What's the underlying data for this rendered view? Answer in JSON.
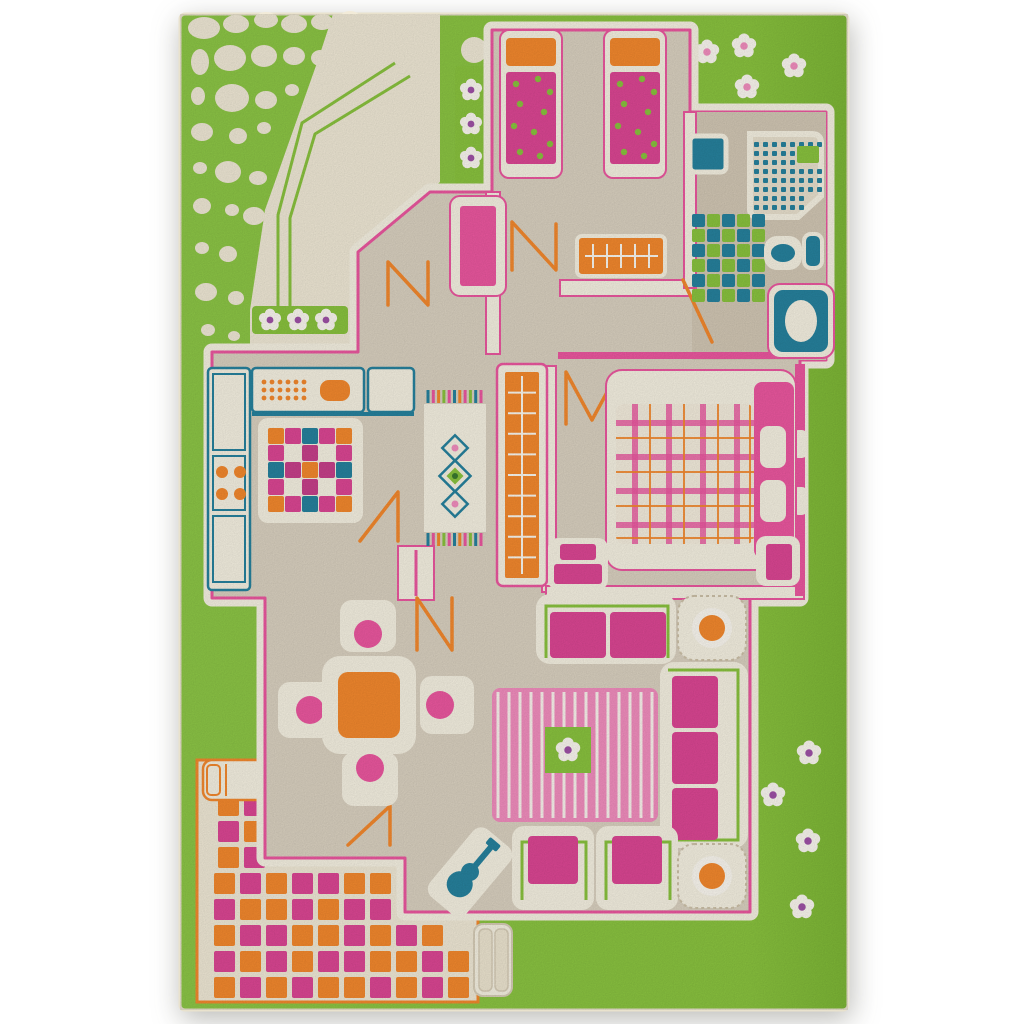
{
  "meta": {
    "description": "Photograph of a 3D children's play rug: green lawn with a playhouse floor plan, furniture, garden pebbles, flowers, tiled patio",
    "object": "play-rug"
  },
  "palette": {
    "bg": "#ffffff",
    "grass": "#8bc53f",
    "grassDeep": "#7eb836",
    "cream": "#f2ebd8",
    "creamBright": "#f8f3e4",
    "floor": "#dcd3c2",
    "floorDark": "#d4c9b6",
    "pink": "#ee58a1",
    "pinkDeep": "#de4795",
    "pinkLight": "#f48fc0",
    "orange": "#f68a2e",
    "teal": "#27839f",
    "lime": "#8bc53f",
    "purple": "#a052a8",
    "white": "#fdfaf2"
  },
  "pebbles": [
    [
      204,
      28,
      16,
      11
    ],
    [
      236,
      24,
      13,
      9
    ],
    [
      266,
      20,
      12,
      8
    ],
    [
      294,
      24,
      13,
      9
    ],
    [
      322,
      22,
      11,
      8
    ],
    [
      350,
      18,
      10,
      7
    ],
    [
      376,
      24,
      9,
      7
    ],
    [
      400,
      20,
      8,
      6
    ],
    [
      422,
      26,
      7,
      5
    ],
    [
      200,
      62,
      9,
      13
    ],
    [
      230,
      58,
      16,
      13
    ],
    [
      264,
      56,
      13,
      11
    ],
    [
      294,
      56,
      11,
      9
    ],
    [
      320,
      58,
      9,
      8
    ],
    [
      344,
      50,
      8,
      7
    ],
    [
      198,
      96,
      7,
      9
    ],
    [
      232,
      98,
      17,
      14
    ],
    [
      266,
      100,
      11,
      9
    ],
    [
      292,
      90,
      7,
      6
    ],
    [
      202,
      132,
      11,
      9
    ],
    [
      238,
      136,
      9,
      8
    ],
    [
      264,
      128,
      7,
      6
    ],
    [
      200,
      168,
      7,
      6
    ],
    [
      228,
      172,
      13,
      11
    ],
    [
      258,
      178,
      9,
      7
    ],
    [
      202,
      206,
      9,
      8
    ],
    [
      232,
      210,
      7,
      6
    ],
    [
      254,
      216,
      11,
      9
    ],
    [
      202,
      248,
      7,
      6
    ],
    [
      228,
      254,
      9,
      8
    ],
    [
      206,
      292,
      11,
      9
    ],
    [
      236,
      298,
      8,
      7
    ],
    [
      208,
      330,
      7,
      6
    ],
    [
      234,
      336,
      6,
      5
    ],
    [
      474,
      50,
      13,
      13
    ]
  ],
  "lawn_flowers": {
    "top_right": [
      [
        707,
        52
      ],
      [
        744,
        46
      ],
      [
        794,
        66
      ],
      [
        747,
        87
      ]
    ],
    "bottom_right": [
      [
        809,
        753
      ],
      [
        773,
        795
      ],
      [
        808,
        841
      ],
      [
        802,
        907
      ]
    ]
  },
  "flower_boxes": {
    "horizontal": {
      "rect": [
        252,
        306,
        96,
        28
      ],
      "flowers": [
        [
          270,
          320
        ],
        [
          298,
          320
        ],
        [
          326,
          320
        ]
      ]
    },
    "vertical": {
      "rect": [
        455,
        66,
        34,
        124
      ],
      "flowers": [
        [
          471,
          90
        ],
        [
          471,
          124
        ],
        [
          471,
          158
        ]
      ]
    }
  },
  "path_accent_lines": [
    "395,63 302,123 278,215 278,310",
    "410,76 315,134 290,218 290,310"
  ],
  "patio": {
    "tile": 21,
    "step": 26,
    "rows": [
      {
        "y": 795,
        "x": 218,
        "cells": "op"
      },
      {
        "y": 821,
        "x": 218,
        "cells": "po"
      },
      {
        "y": 847,
        "x": 218,
        "cells": "op"
      },
      {
        "y": 873,
        "x": 214,
        "cells": "opoppoo"
      },
      {
        "y": 899,
        "x": 214,
        "cells": "poopopp"
      },
      {
        "y": 925,
        "x": 214,
        "cells": "oppoopopo"
      },
      {
        "y": 951,
        "x": 214,
        "cells": "popoppoopo"
      },
      {
        "y": 977,
        "x": 214,
        "cells": "opopoopopo"
      }
    ]
  },
  "kitchen_rug": {
    "x": 268,
    "y": 428,
    "cell": 17,
    "rows": [
      "optpo",
      "p.m.p",
      "tmomt",
      "p.m.p",
      "optpo"
    ]
  },
  "bath_mat": {
    "x": 692,
    "y": 214,
    "cell": 13,
    "step": 15,
    "rows": [
      "tltlt",
      "ltltl",
      "tltlt",
      "ltltl",
      "tltlt",
      "ltltl"
    ]
  },
  "shower": {
    "dots": {
      "x": 754,
      "y": 142,
      "cols": 8,
      "rows": 8,
      "step": 9,
      "size": 5
    },
    "lime_patch": [
      797,
      146,
      22,
      17
    ]
  },
  "bed_dots": {
    "beds": [
      [
        506,
        72
      ],
      [
        610,
        72
      ]
    ],
    "offsets": [
      [
        10,
        12
      ],
      [
        32,
        7
      ],
      [
        44,
        20
      ],
      [
        14,
        32
      ],
      [
        38,
        40
      ],
      [
        8,
        54
      ],
      [
        28,
        60
      ],
      [
        44,
        72
      ],
      [
        14,
        80
      ],
      [
        34,
        84
      ]
    ]
  },
  "plaid": {
    "origin": [
      616,
      404
    ],
    "size": [
      138,
      140
    ],
    "pink": [
      16,
      50,
      84,
      118
    ],
    "orange": [
      33,
      67,
      101,
      133
    ],
    "band": 6,
    "thin": 2
  },
  "stripes": {
    "x": 498,
    "count": 15,
    "step": 11,
    "y1": 692,
    "y2": 818
  },
  "stairs": {
    "x": 505,
    "y": 372,
    "w": 34,
    "h": 206,
    "steps": 9
  },
  "runner": {
    "fringe_colors": [
      "#27839f",
      "#ee58a1",
      "#f68a2e",
      "#8bc53f",
      "#ee58a1",
      "#27839f",
      "#f68a2e",
      "#ee58a1",
      "#8bc53f",
      "#27839f",
      "#ee58a1"
    ]
  },
  "zigzags": {
    "hall_entry": "388,305 388,262 428,305 428,262",
    "bedroom_door": "512,270 512,222 556,270 556,224",
    "master_door": "566,424 566,372 592,420 618,372 618,424",
    "living_door": "417,650 417,598 452,650 452,598",
    "kitchen_door": "360,541 398,492 398,541",
    "bath_door": "683,280 712,342",
    "patio_door": "348,845 390,806 390,845"
  }
}
